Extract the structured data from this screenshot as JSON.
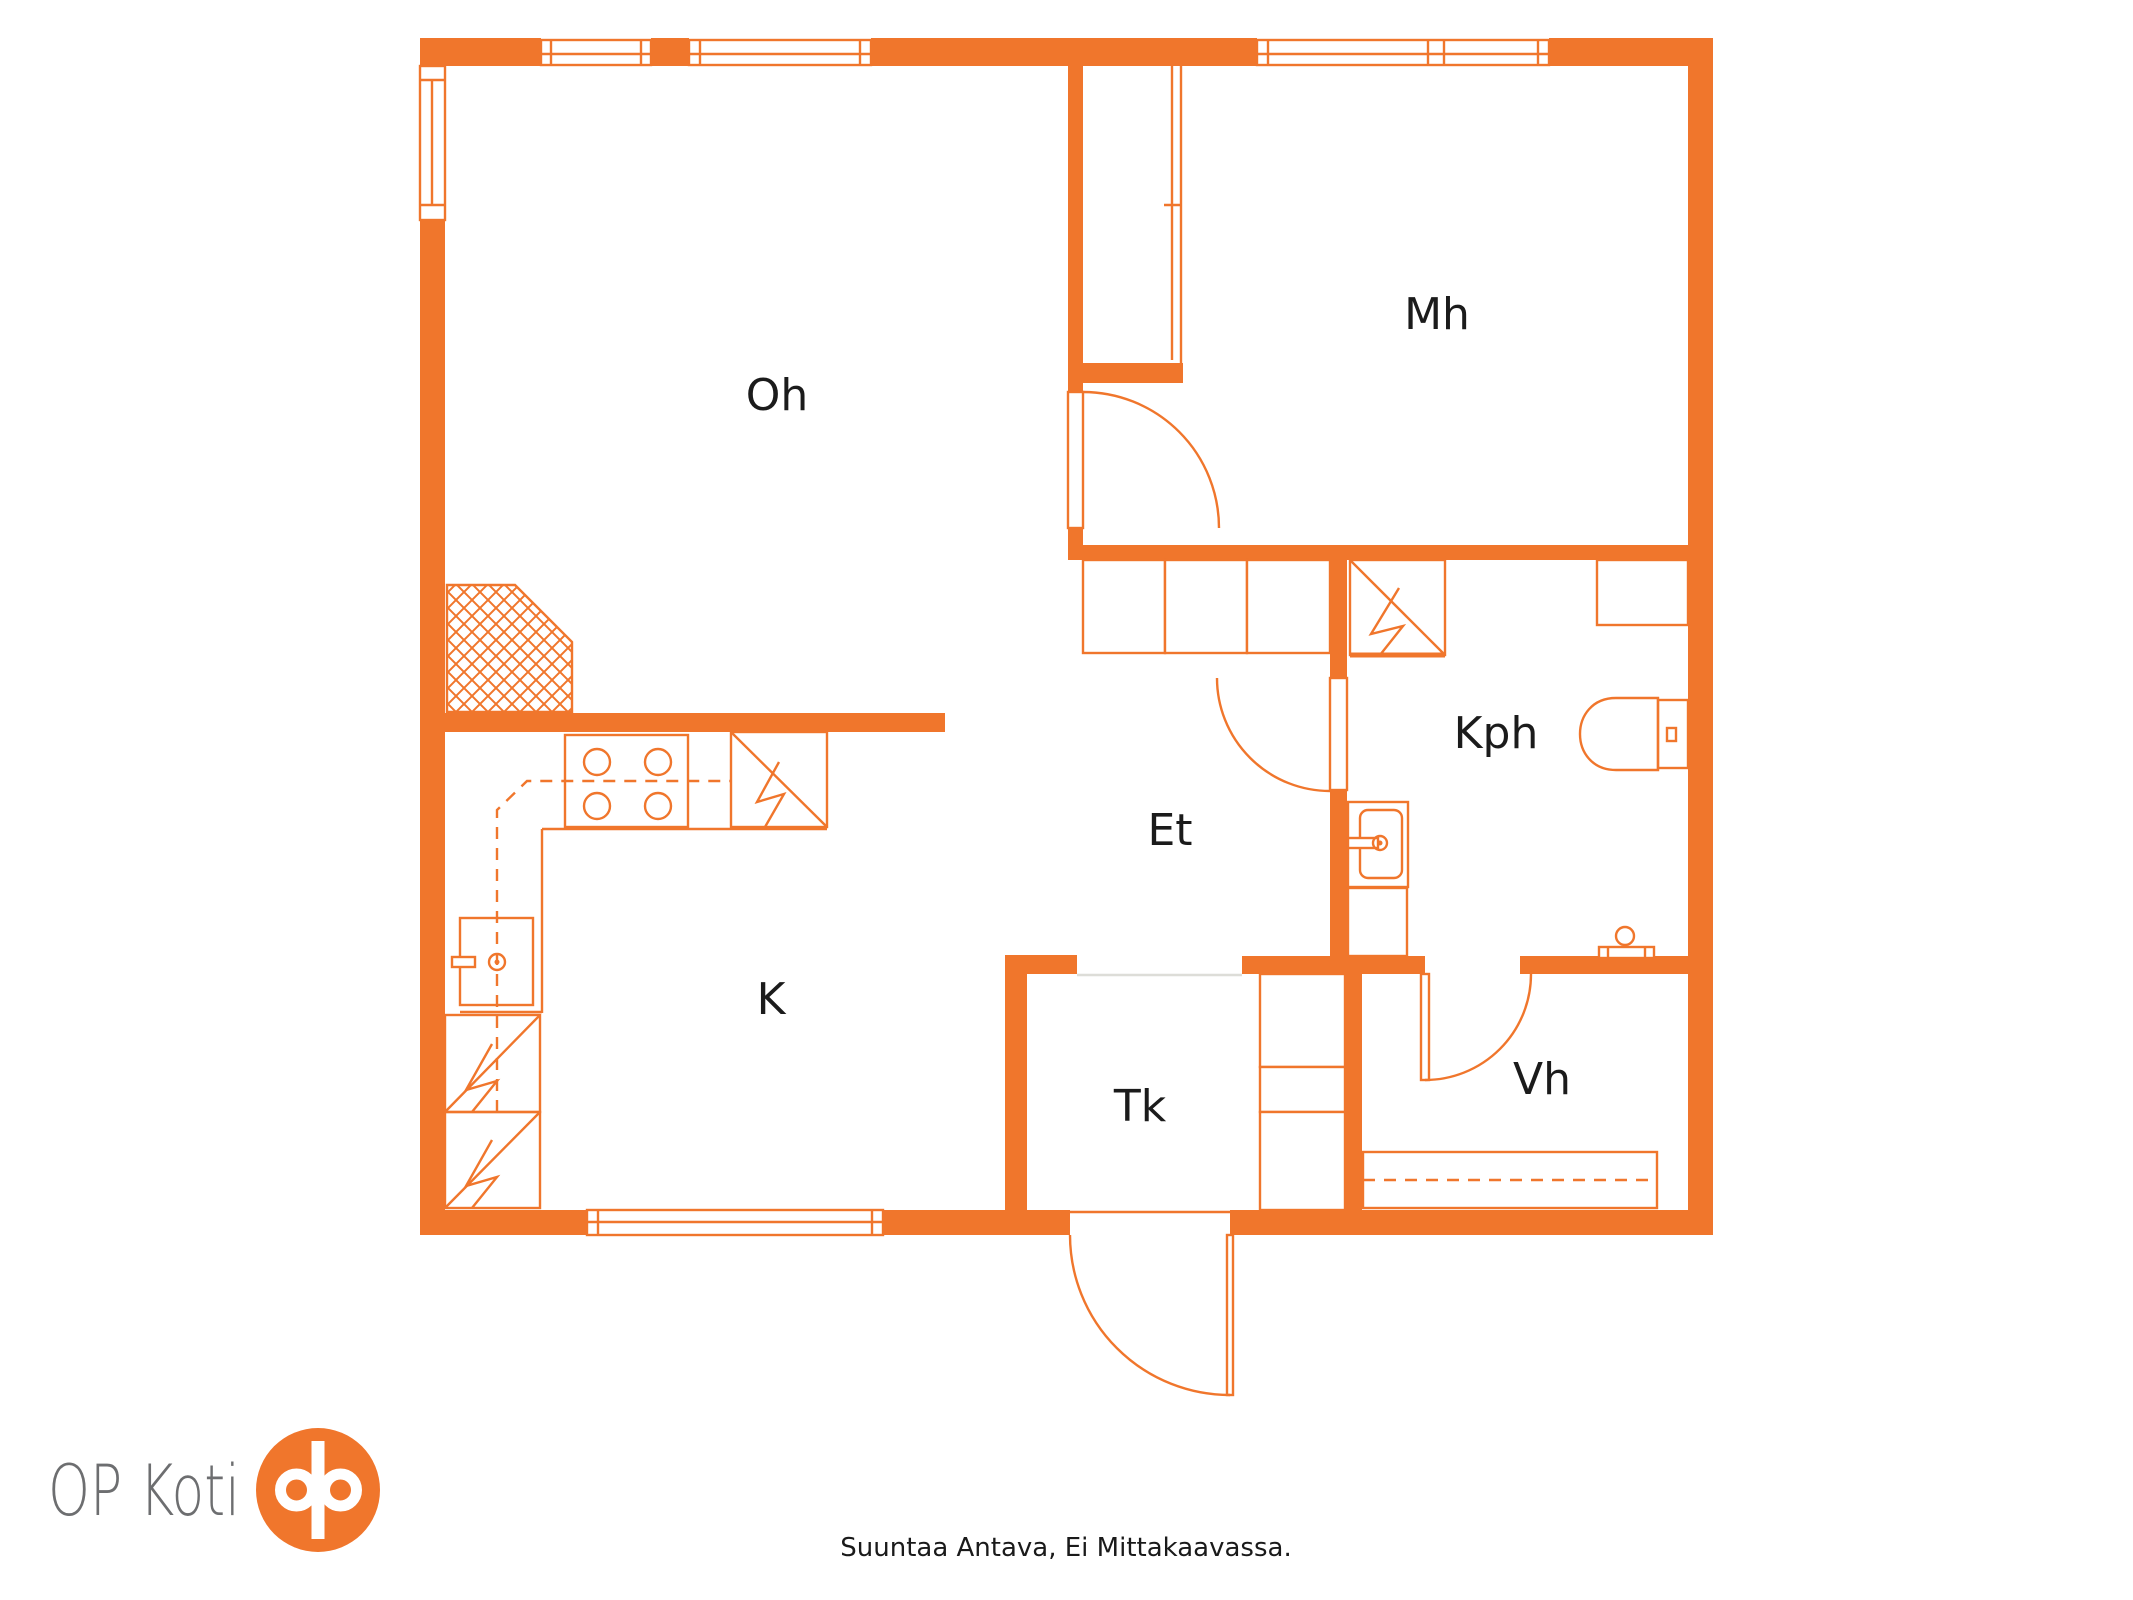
{
  "colors": {
    "accent": "#F0762C",
    "label": "#1b1b1b",
    "logo_text_gray": "#6d6e70",
    "background": "#ffffff"
  },
  "rooms": [
    {
      "label": "Oh"
    },
    {
      "label": "Mh"
    },
    {
      "label": "Kph"
    },
    {
      "label": "Et"
    },
    {
      "label": "K"
    },
    {
      "label": "Tk"
    },
    {
      "label": "Vh"
    }
  ],
  "logo": {
    "text": "OP Koti"
  },
  "footer": {
    "disclaimer": "Suuntaa Antava, Ei Mittakaavassa."
  }
}
